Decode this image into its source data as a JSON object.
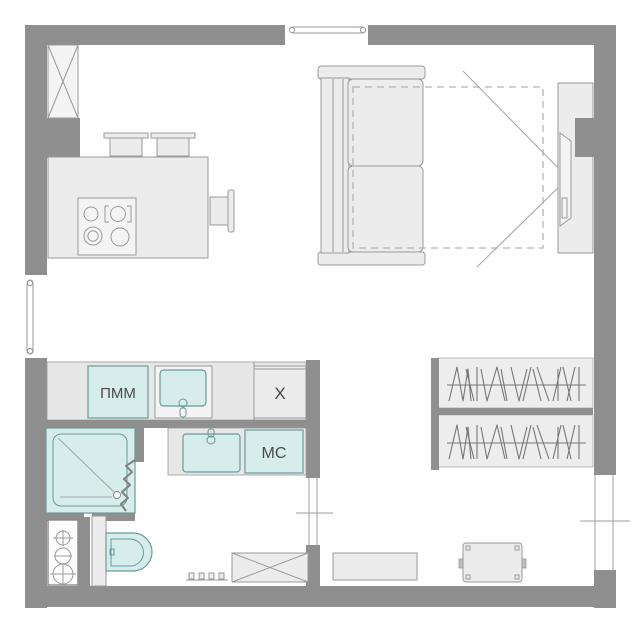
{
  "plan": {
    "title": "studio apartment floor plan",
    "labels": {
      "dishwasher": "ПММ",
      "fridge": "X",
      "washing_machine": "МС"
    },
    "colors": {
      "wall": "#8f8f8f",
      "furniture_fill": "#ececec",
      "counter_fill": "#e7e7e7",
      "fixture_fill": "#d6edeb",
      "fixture_border": "#679b99",
      "outline": "#9a9a9a",
      "dashed": "#b3b3b3",
      "background": "#ffffff"
    },
    "fixtures": [
      "vent-shaft",
      "kitchen-island",
      "stove-4-burners",
      "bar-stool",
      "bar-stool",
      "side-chair",
      "sofa-bed",
      "fold-out-bed-dashed-outline",
      "tv-panel",
      "tv",
      "kitchen-counter",
      "dishwasher",
      "kitchen-sink",
      "fridge",
      "bathroom-sink",
      "washing-machine",
      "shower-cabin",
      "shower-door-zigzag",
      "toilet",
      "utility-meter-box",
      "crossed-storage-box",
      "radiator",
      "bench",
      "pouf-table",
      "wardrobe-rail-upper",
      "wardrobe-rail-lower",
      "window-top",
      "window-left",
      "window-right",
      "bathroom-door-opening"
    ]
  }
}
